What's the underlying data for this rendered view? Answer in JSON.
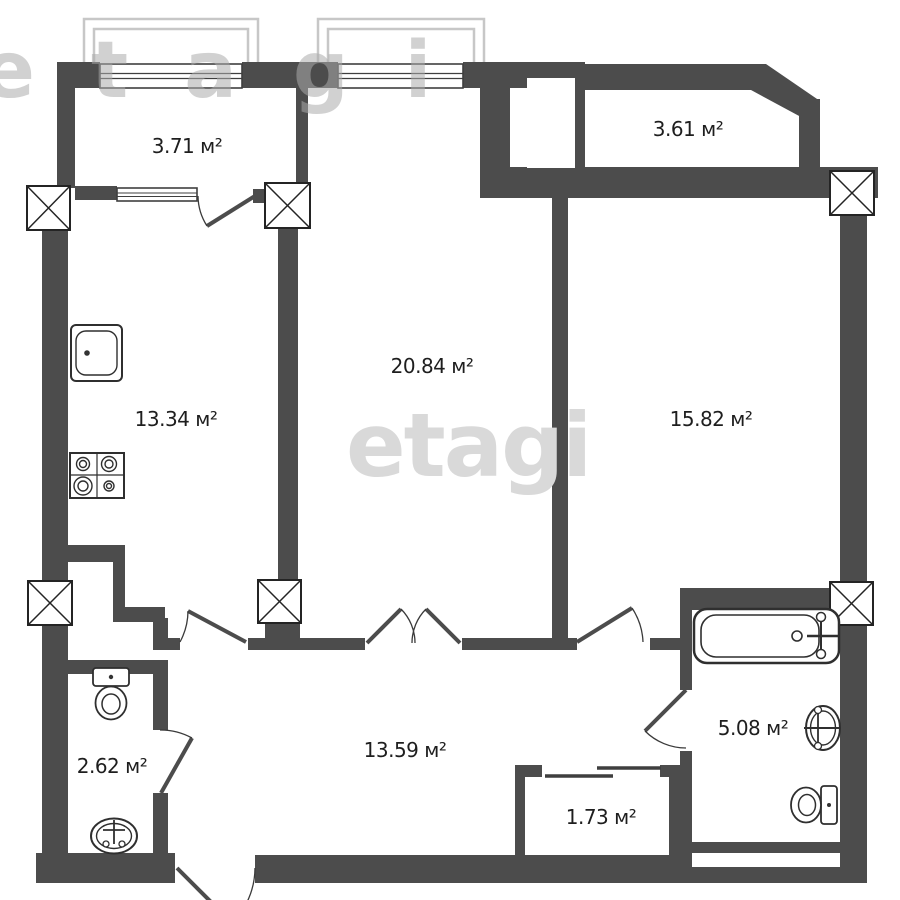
{
  "plan_title": "apartment-floor-plan",
  "area_unit": "м²",
  "rooms": [
    {
      "id": "loggia-left",
      "area": "3.71 м²"
    },
    {
      "id": "kitchen",
      "area": "13.34 м²"
    },
    {
      "id": "living-room",
      "area": "20.84 м²"
    },
    {
      "id": "loggia-right",
      "area": "3.61 м²"
    },
    {
      "id": "bedroom",
      "area": "15.82 м²"
    },
    {
      "id": "wc",
      "area": "2.62 м²"
    },
    {
      "id": "hallway",
      "area": "13.59 м²"
    },
    {
      "id": "storage",
      "area": "1.73 м²"
    },
    {
      "id": "bathroom",
      "area": "5.08 м²"
    }
  ],
  "watermark": {
    "top": "etagi",
    "center": "etagi"
  },
  "fixtures": [
    "kitchen-sink",
    "stove",
    "toilet",
    "wash-basin",
    "bathtub",
    "sliding-door",
    "column-marker",
    "window",
    "balcony-rail",
    "vent-shaft"
  ],
  "colors": {
    "wall": "#4c4c4c",
    "fixture_line": "#2f2f2f",
    "balcony_rail": "#c7c7c7",
    "watermark": "#d9d9d9",
    "label": "#1e1e1e",
    "background": "#ffffff"
  }
}
